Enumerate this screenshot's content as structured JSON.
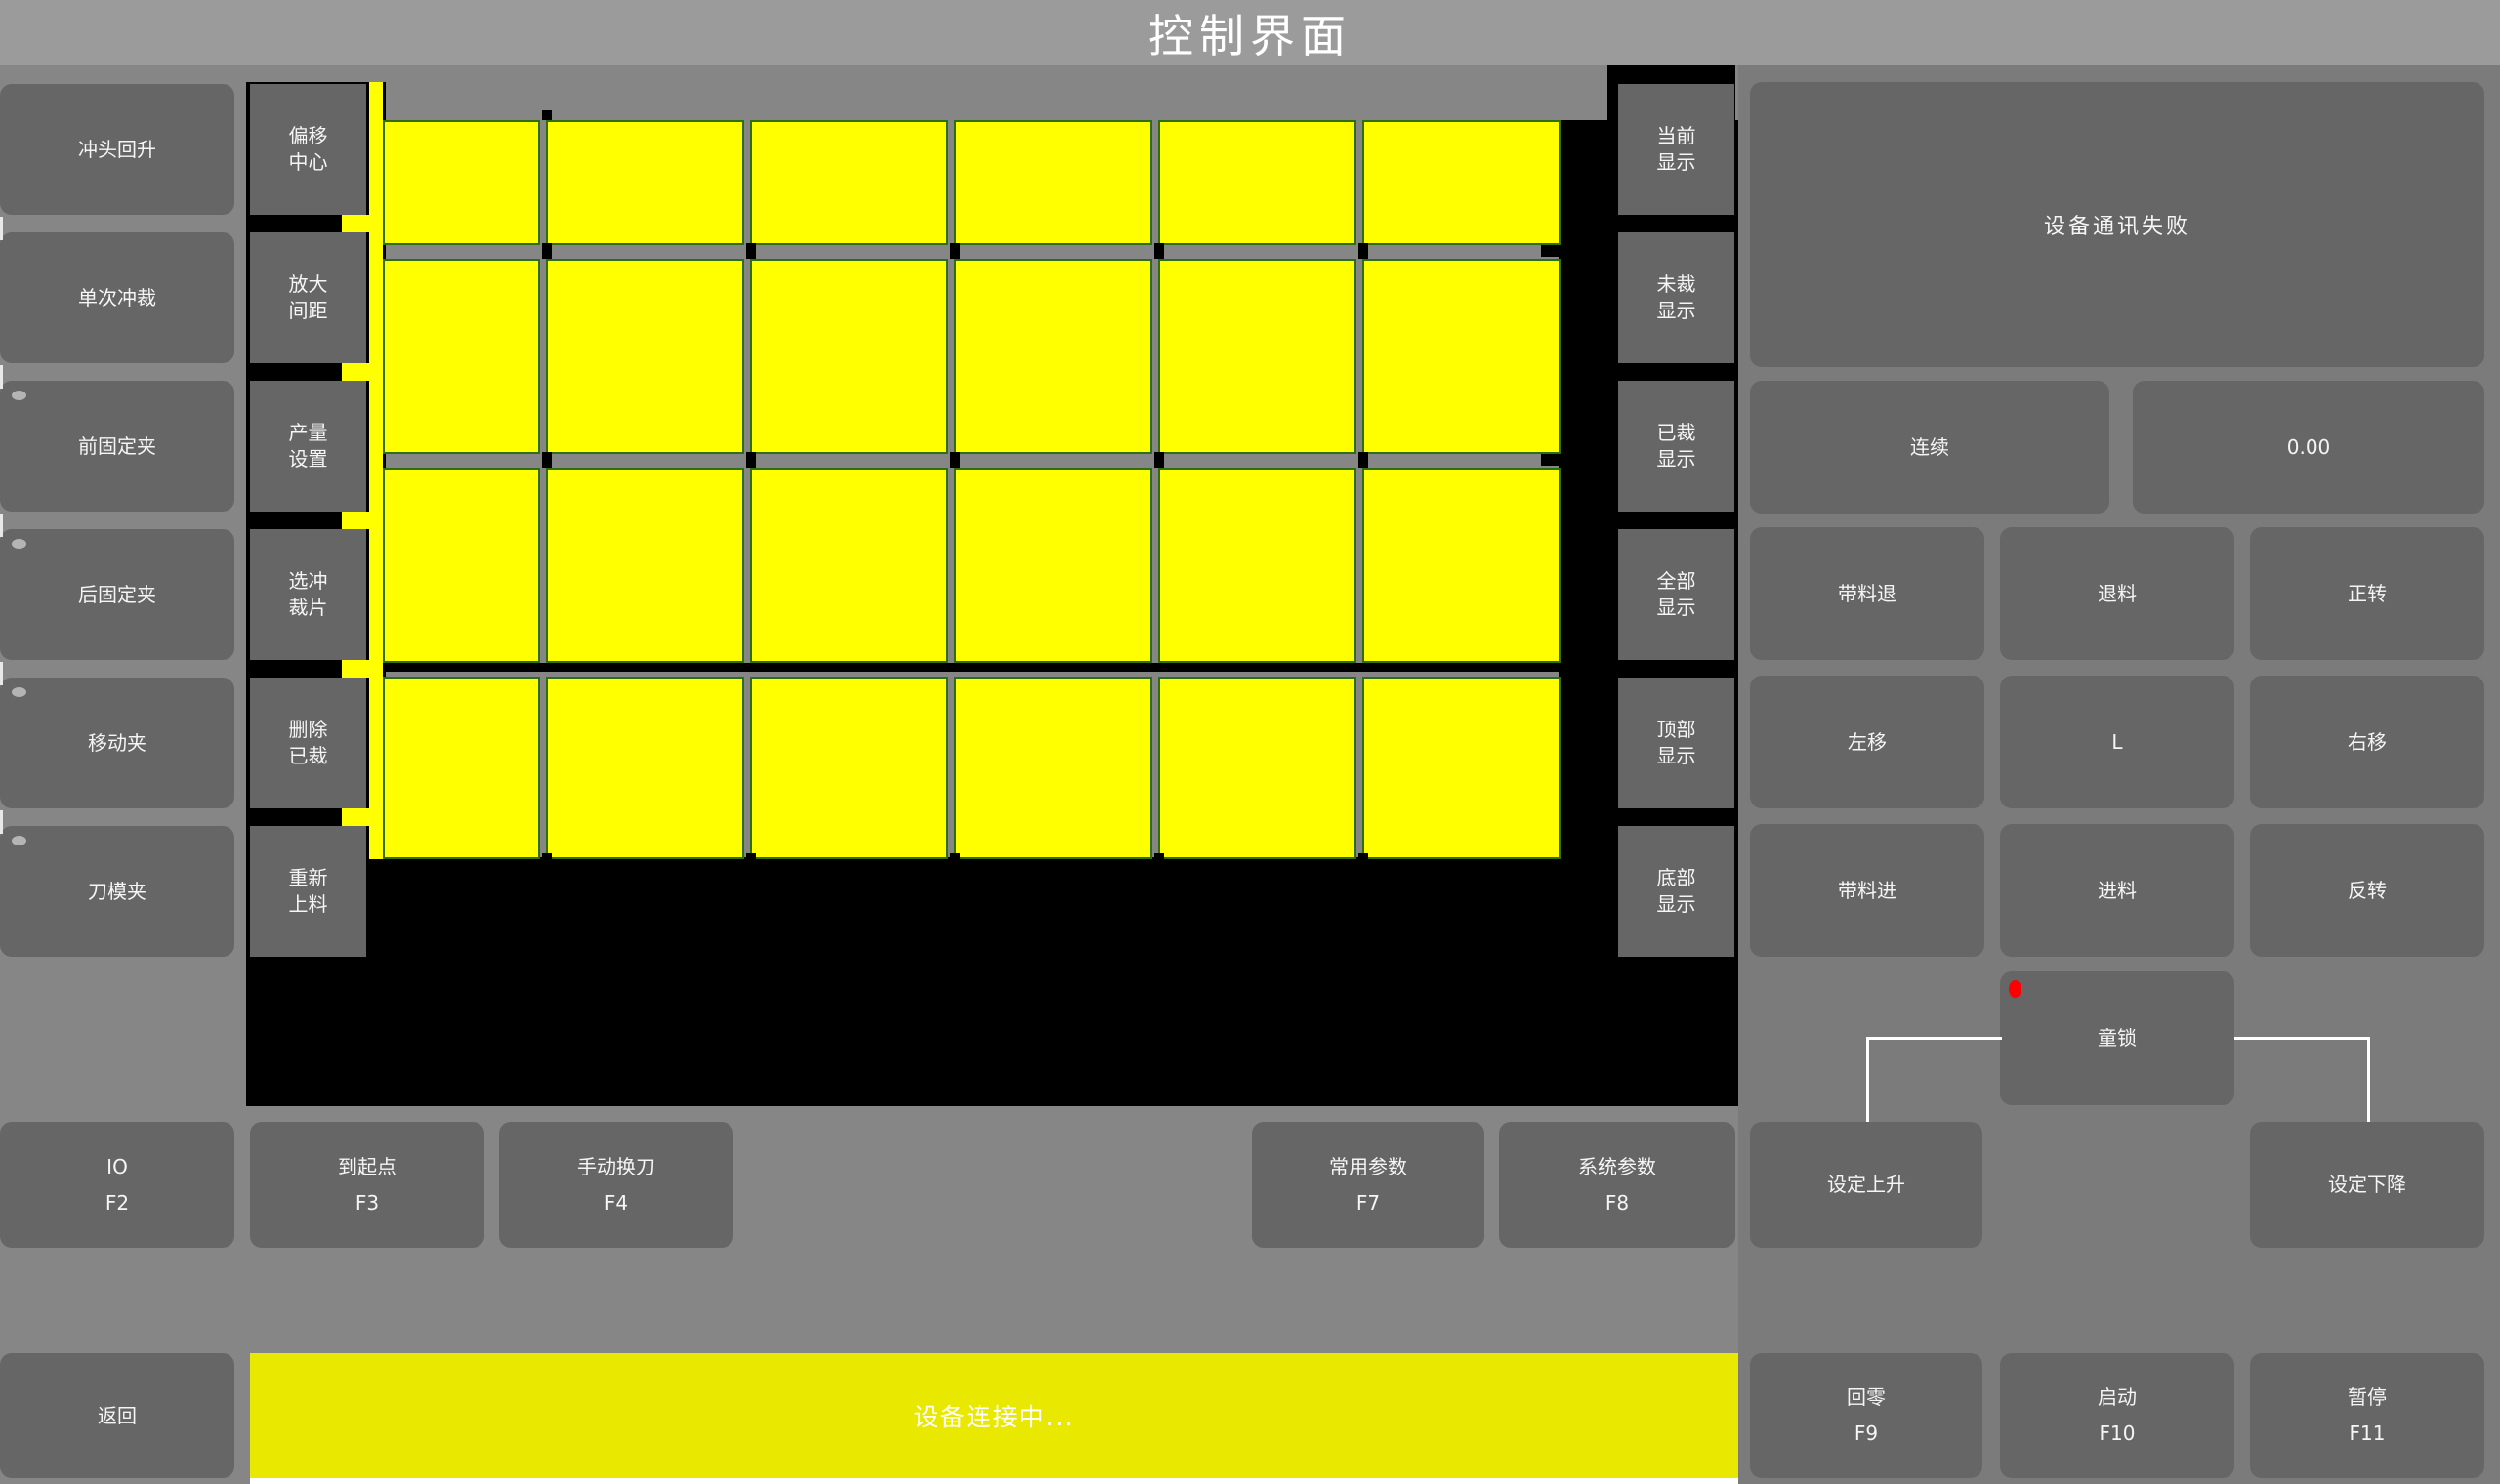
{
  "title": "控制界面",
  "left_panel": {
    "buttons": [
      {
        "label": "冲头回升",
        "indicator": false
      },
      {
        "label": "单次冲裁",
        "indicator": false
      },
      {
        "label": "前固定夹",
        "indicator": true
      },
      {
        "label": "后固定夹",
        "indicator": true
      },
      {
        "label": "移动夹",
        "indicator": true
      },
      {
        "label": "刀模夹",
        "indicator": true
      }
    ]
  },
  "tool_panel": {
    "buttons": [
      {
        "label": "偏移中心"
      },
      {
        "label": "放大间距"
      },
      {
        "label": "产量设置"
      },
      {
        "label": "选冲裁片"
      },
      {
        "label": "删除已裁"
      },
      {
        "label": "重新上料"
      }
    ]
  },
  "display_panel": {
    "buttons": [
      {
        "label": "当前显示"
      },
      {
        "label": "未裁显示"
      },
      {
        "label": "已裁显示"
      },
      {
        "label": "全部显示"
      },
      {
        "label": "顶部显示"
      },
      {
        "label": "底部显示"
      }
    ]
  },
  "material_view": {
    "description": "sheet cutting layout preview",
    "columns": 6,
    "rows": 4,
    "piece_color": "#ffff00",
    "all_pieces_uncut": true
  },
  "right_panel": {
    "status_message": "设备通讯失败",
    "mode_button": "连续",
    "value_display": "0.00",
    "jog_buttons": [
      "带料退",
      "退料",
      "正转",
      "左移",
      "L",
      "右移",
      "带料进",
      "进料",
      "反转"
    ],
    "child_lock": {
      "label": "童锁",
      "alert": true
    }
  },
  "function_row": {
    "keys": [
      {
        "label": "IO",
        "key": "F2"
      },
      {
        "label": "到起点",
        "key": "F3"
      },
      {
        "label": "手动换刀",
        "key": "F4"
      },
      {
        "label": "常用参数",
        "key": "F7"
      },
      {
        "label": "系统参数",
        "key": "F8"
      }
    ],
    "set_rise": "设定上升",
    "set_fall": "设定下降"
  },
  "bottom_bar": {
    "back_button": "返回",
    "status_text": "设备连接中...",
    "keys": [
      {
        "label": "回零",
        "key": "F9"
      },
      {
        "label": "启动",
        "key": "F10"
      },
      {
        "label": "暂停",
        "key": "F11"
      }
    ]
  },
  "colors": {
    "title_bg": "#9b9b9b",
    "page_bg": "#868686",
    "panel_bg": "#7b7b7b",
    "button_bg": "#666666",
    "button_text": "#f5f5f5",
    "canvas_black": "#000000",
    "piece_yellow": "#ffff00",
    "piece_border": "#2e6e10",
    "status_bar_yellow": "#e8e800",
    "alert_red": "#ff0000",
    "connector_white": "#ffffff",
    "indicator_gray": "#b4b4b4"
  }
}
